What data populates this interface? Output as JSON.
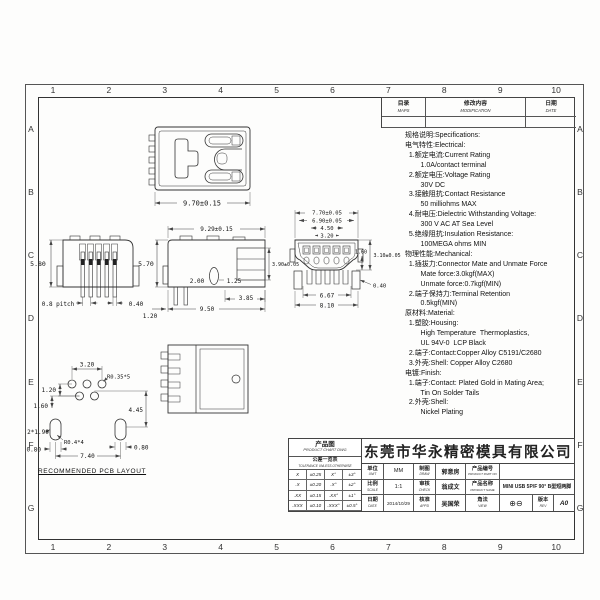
{
  "zones": {
    "cols": [
      "1",
      "2",
      "3",
      "4",
      "5",
      "6",
      "7",
      "8",
      "9",
      "10"
    ],
    "rows": [
      "A",
      "B",
      "C",
      "D",
      "E",
      "F",
      "G"
    ]
  },
  "rev_table": {
    "mark_cn": "目录",
    "mark_en": "MAPS",
    "mod_cn": "修改内容",
    "mod_en": "MODIFICATION",
    "date_cn": "日期",
    "date_en": "DATE"
  },
  "specs": {
    "lines": [
      "规格说明:Specifications:",
      "电气特性:Electrical:",
      "  1.额定电流:Current Rating",
      "        1.0A/contact terminal",
      "  2.额定电压:Voltage Rating",
      "        30V DC",
      "  3.接触阻抗:Contact Resistance",
      "        50 milliohms MAX",
      "  4.耐电压:Dielectric Withstanding Voltage:",
      "        300 V AC AT Sea Level",
      "  5.绝缘阻抗:Insulation Resistance:",
      "        100MEGA ohms MIN",
      "物理性能:Mechanical:",
      "  1.插拔力:Connector Mate and Unmate Force",
      "        Mate force:3.0kgf(MAX)",
      "        Unmate force:0.7kgf(MIN)",
      "  2.端子保持力:Terminal Retention",
      "        0.5kgf(MIN)",
      "原材料:Material:",
      "  1.塑胶:Housing:",
      "        High Temperature  Thermoplastics,",
      "        UL 94V-0  LCP Black",
      "  2.端子:Contact:Copper Alloy C5191/C2680",
      "  3.外壳:Shell: Copper Alloy C2680",
      "电镀:Finish:",
      "  1.端子:Contact: Plated Gold in Mating Area;",
      "        Tin On Solder Tails",
      "  2.外壳:Shell:",
      "        Nickel Plating"
    ]
  },
  "dims": {
    "front": {
      "width": "9.70±0.15"
    },
    "side": {
      "height": "5.80",
      "pitch": "0.8 pitch",
      "pin_width": "0.40"
    },
    "profile": {
      "depth": "9.29±0.15",
      "height": "5.70",
      "rear_height": "3.90±0.05",
      "lead": "2.00",
      "boss": "1.25",
      "d385": "3.85",
      "d950": "9.50",
      "d120": "1.20"
    },
    "mating": {
      "w770": "7.70±0.05",
      "w690": "6.90±0.05",
      "w450": "4.50",
      "w320": "3.20",
      "h160": "1.60",
      "h310": "3.10±0.05",
      "leg040": "0.40",
      "b667": "6.67",
      "b810": "8.10"
    },
    "pcb": {
      "d320": "3.20",
      "r035": "R0.35*5",
      "d120": "1.20",
      "d160": "1.60",
      "d445": "4.45",
      "slot": "2*1.90",
      "r04": "R0.4*4",
      "d080l": "0.80",
      "d740": "7.40",
      "d080r": "0.80",
      "caption": "RECOMMENDED PCB LAYOUT"
    }
  },
  "title_block": {
    "product_chart": {
      "cn": "产品图",
      "en": "PRODUCT CHART DWG"
    },
    "tolerance": {
      "header_cn": "公差一览表",
      "header_en": "TOLERANCE UNLESS OTHERWISE",
      "rows": [
        [
          "X",
          "±0.25",
          "X°",
          "±3°"
        ],
        [
          ".X",
          "±0.20",
          ".X°",
          "±2°"
        ],
        [
          ".XX",
          "±0.15",
          ".XX°",
          "±1°"
        ],
        [
          ".XXX",
          "±0.10",
          ".XXX°",
          "±0.5°"
        ]
      ]
    },
    "company": "东莞市华永精密模具有限公司",
    "unit": {
      "cn": "单位",
      "en": "UNIT",
      "value": "MM"
    },
    "scale": {
      "cn": "比例",
      "en": "SCALE",
      "value": "1:1"
    },
    "date": {
      "cn": "日期",
      "en": "DATE",
      "value": "2014/10/29"
    },
    "drawn": {
      "cn": "制图",
      "en": "DRAW",
      "value": "郭意房"
    },
    "checked": {
      "cn": "审核",
      "en": "CHECK",
      "value": "翁成文"
    },
    "approved": {
      "cn": "核准",
      "en": "APPD",
      "value": "吴国荣"
    },
    "part_no": {
      "cn": "产品编号",
      "en": "PRODUCT PART NO",
      "value": ""
    },
    "product_name": {
      "cn": "产品名称",
      "en": "PRODUCT NAME",
      "value": "MINI USB 5P/F 90° B型短两脚"
    },
    "projection": {
      "cn": "角法",
      "en": "VIEW",
      "symbol": "⊕⊖"
    },
    "version": {
      "cn": "版本",
      "en": "REV",
      "value": "A0"
    }
  }
}
